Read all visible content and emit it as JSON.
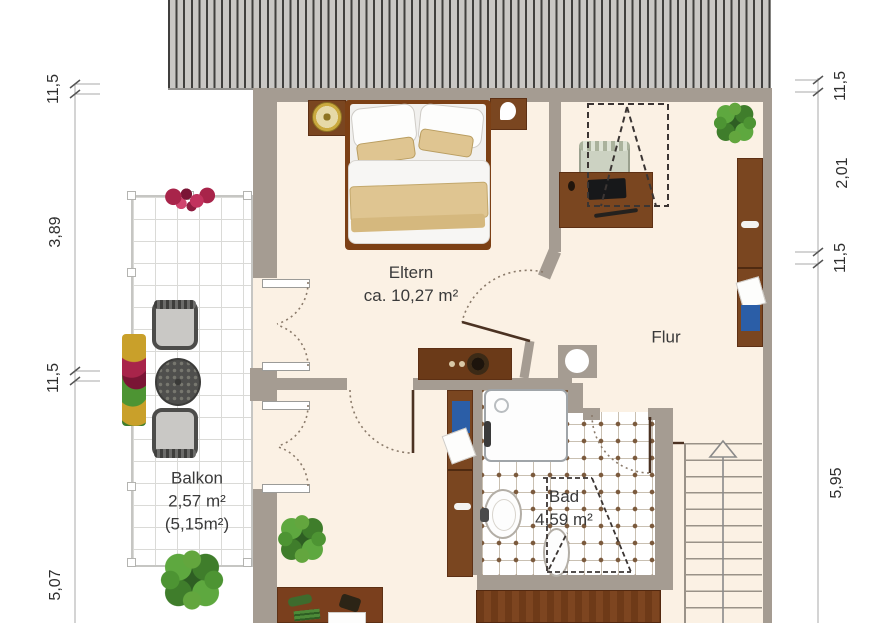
{
  "rooms": {
    "eltern": {
      "name": "Eltern",
      "area": "ca. 10,27 m²"
    },
    "flur": {
      "name": "Flur"
    },
    "bad": {
      "name": "Bad",
      "area": "4,59 m²"
    },
    "balkon": {
      "name": "Balkon",
      "area": "2,57 m²",
      "area_gross": "(5,15m²)"
    }
  },
  "dimensions": {
    "left": {
      "d1": "11,5",
      "d2": "3,89",
      "d3": "11,5",
      "d4": "5,07"
    },
    "right": {
      "d1": "11,5",
      "d2": "2,01",
      "d3": "11,5",
      "d4": "5,95"
    }
  },
  "colors": {
    "wall": "#a59c92",
    "floor": "#fbf1e4",
    "roof": "#c9c7c4",
    "wood": "#7a4620",
    "wood_dark": "#6b3a18",
    "tan": "#dfc591",
    "blue": "#2b5ea7",
    "green": "#4a8f3a"
  }
}
